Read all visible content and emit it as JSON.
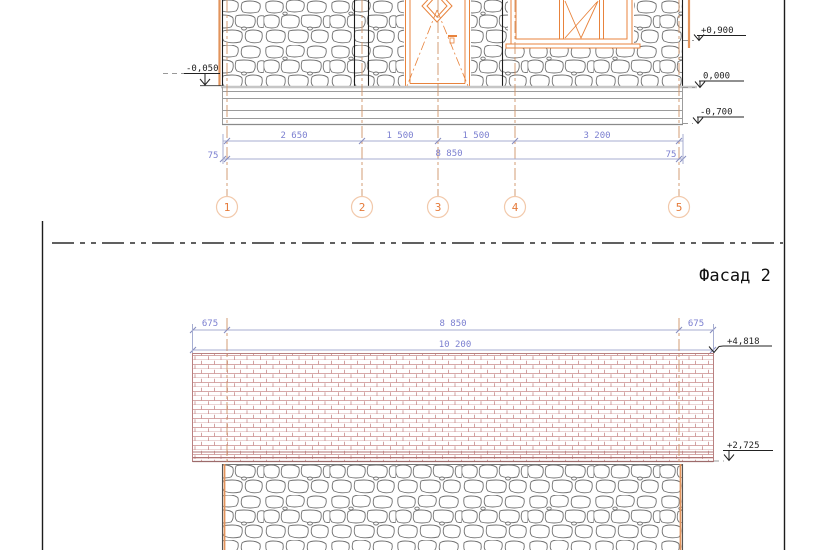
{
  "drawing": {
    "facade2_label": "Фасад 2",
    "facade1": {
      "axis_labels": [
        "1",
        "2",
        "3",
        "4",
        "5"
      ],
      "dim_segments": [
        "2 650",
        "1 500",
        "1 500",
        "3 200"
      ],
      "dim_total": "8 850",
      "dim_side_left": "75",
      "dim_side_right": "75",
      "level_left": "-0,050",
      "level_sill": "+0,900",
      "level_zero": "0,000",
      "level_base": "-0,700"
    },
    "facade2": {
      "dim_overhang_left": "675",
      "dim_span": "8 850",
      "dim_overhang_right": "675",
      "dim_total": "10 200",
      "level_roof_top": "+4,818",
      "level_eaves": "+2,725"
    },
    "colors": {
      "frame_orange": "#e8833c",
      "axis_orange": "#cf9468",
      "dimension_blue": "#7b7fd0",
      "roof_red": "#c98c8c",
      "stone_gray": "#707070"
    }
  }
}
